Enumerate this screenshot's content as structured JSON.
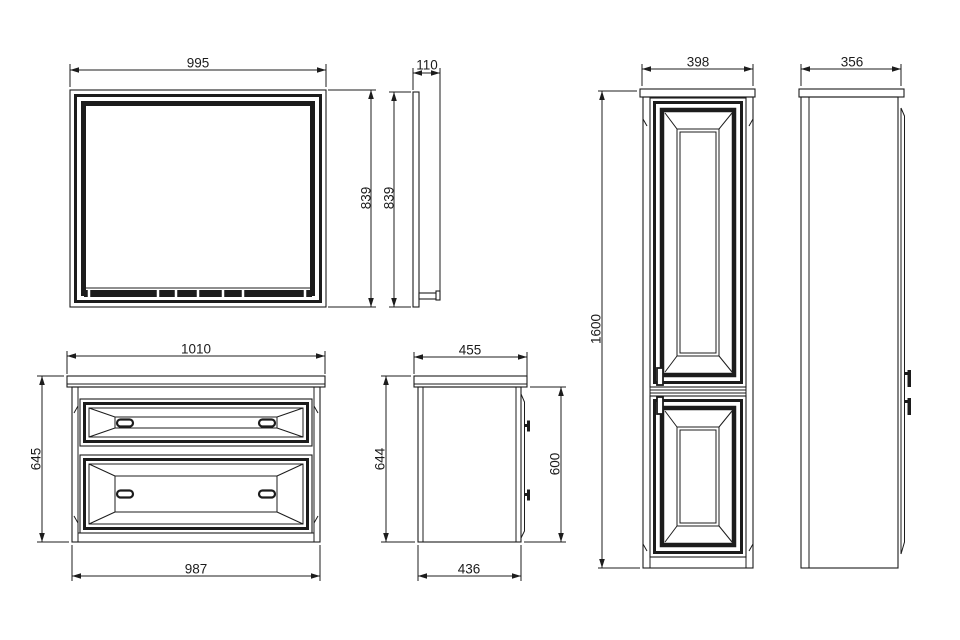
{
  "sheet": {
    "background_color": "#ffffff",
    "line_color": "#1c1c1c"
  },
  "dims": {
    "mirror_front": {
      "width": "995",
      "height": "839"
    },
    "mirror_side": {
      "height": "839",
      "depth": "110"
    },
    "vanity_front": {
      "top_width": "1010",
      "height": "645",
      "bottom_width": "987"
    },
    "vanity_side": {
      "top_depth": "455",
      "overall_height": "644",
      "body_height": "600",
      "bottom_depth": "436"
    },
    "tall_cabinet_front": {
      "width": "398",
      "height": "1600"
    },
    "tall_cabinet_side": {
      "depth": "356"
    }
  }
}
